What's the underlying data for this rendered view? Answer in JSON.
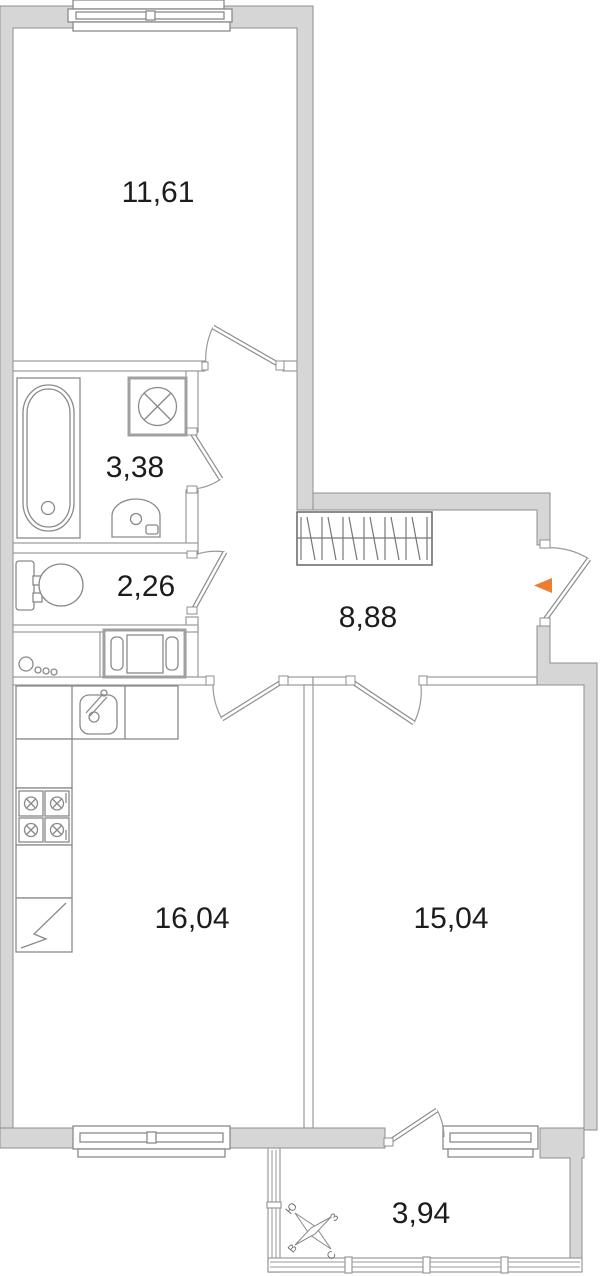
{
  "plan": {
    "rooms": [
      {
        "id": "bedroom",
        "area": "11,61"
      },
      {
        "id": "bathroom",
        "area": "3,38"
      },
      {
        "id": "toilet",
        "area": "2,26"
      },
      {
        "id": "hallway",
        "area": "8,88"
      },
      {
        "id": "kitchen",
        "area": "16,04"
      },
      {
        "id": "living-room",
        "area": "15,04"
      },
      {
        "id": "balcony",
        "area": "3,94"
      }
    ],
    "compass": {
      "north": "С",
      "south": "Ю",
      "west": "З",
      "east": "В"
    },
    "colors": {
      "wall_fill": "#d6d6d6",
      "wall_stroke": "#8f8f8f",
      "entrance_marker": "#ED7D31",
      "label": "#1c1c1c"
    }
  }
}
